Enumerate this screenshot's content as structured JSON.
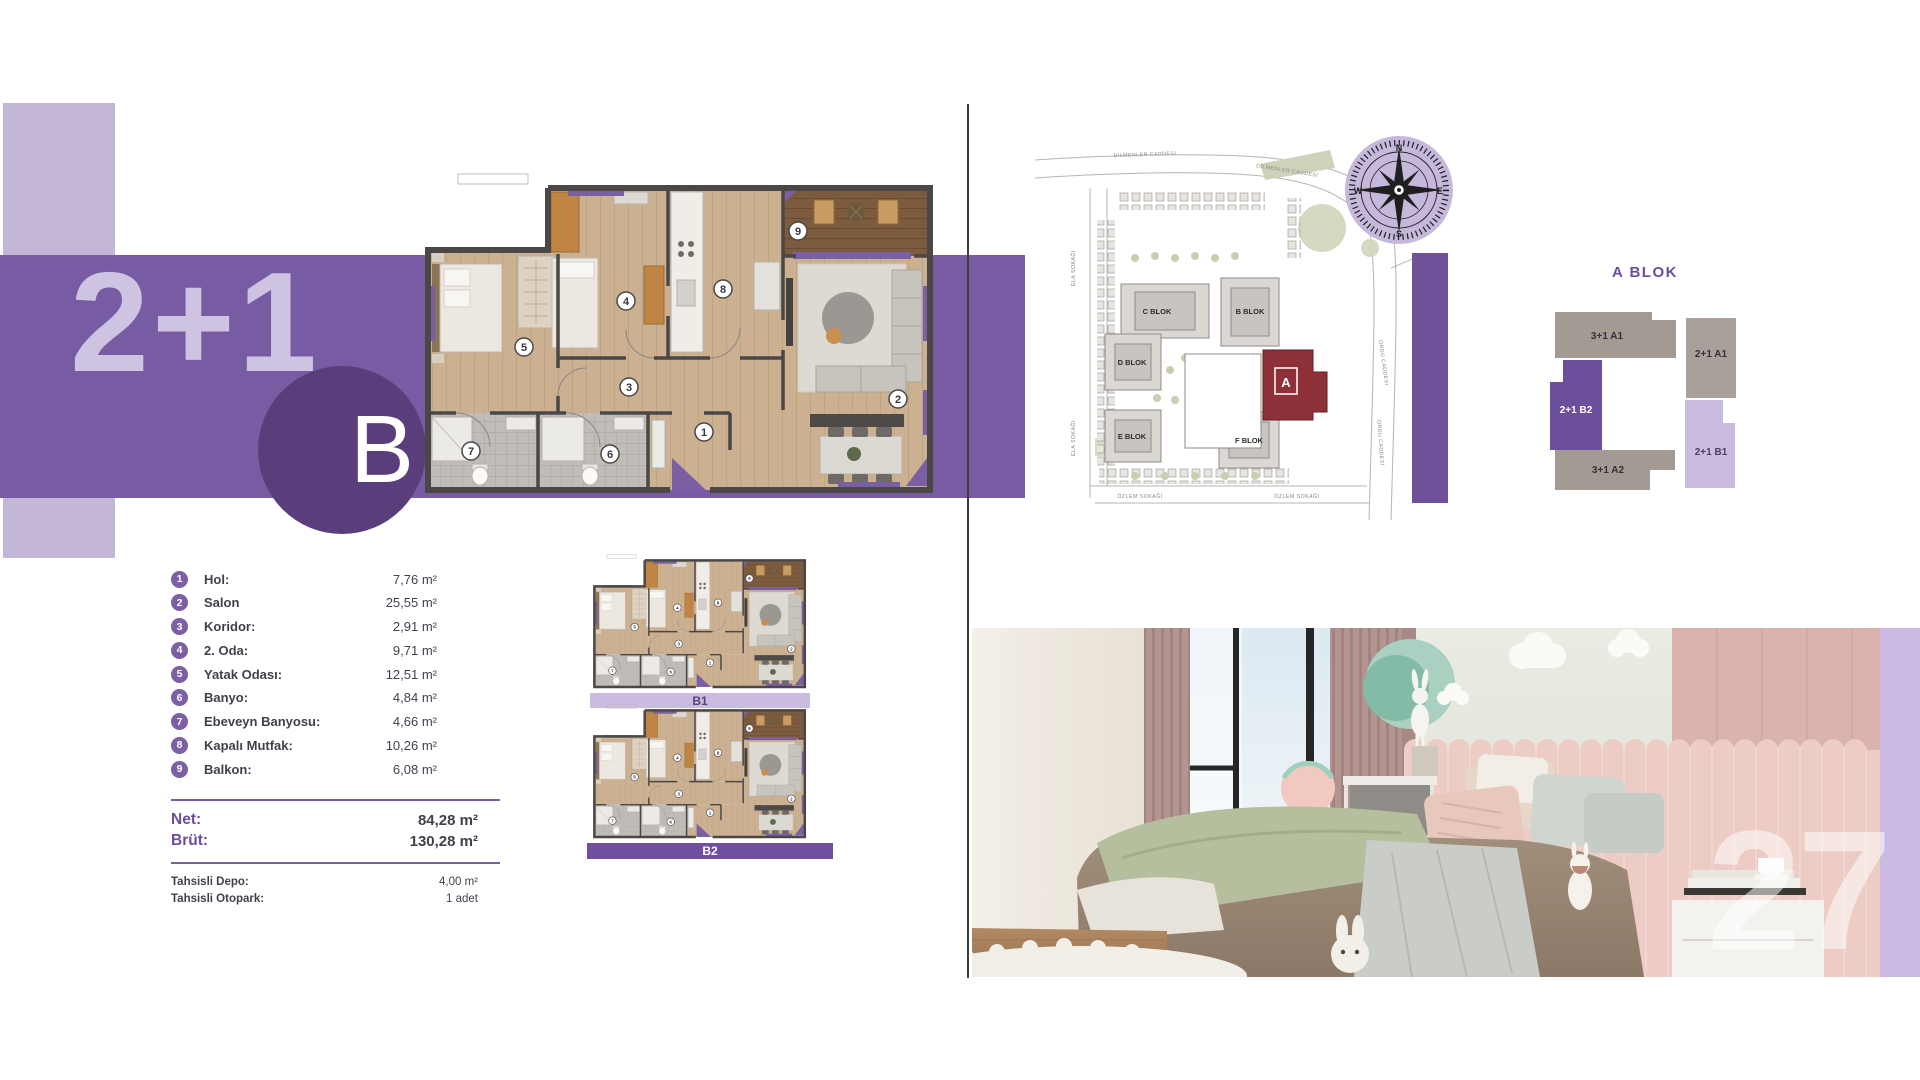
{
  "unit": {
    "type_label": "2+1",
    "variant_label": "B"
  },
  "room_list": [
    {
      "num": "1",
      "label": "Hol:",
      "area": "7,76 m²"
    },
    {
      "num": "2",
      "label": "Salon",
      "area": "25,55 m²"
    },
    {
      "num": "3",
      "label": "Koridor:",
      "area": "2,91 m²"
    },
    {
      "num": "4",
      "label": "2. Oda:",
      "area": "9,71 m²"
    },
    {
      "num": "5",
      "label": "Yatak Odası:",
      "area": "12,51 m²"
    },
    {
      "num": "6",
      "label": "Banyo:",
      "area": "4,84 m²"
    },
    {
      "num": "7",
      "label": "Ebeveyn Banyosu:",
      "area": "4,66 m²"
    },
    {
      "num": "8",
      "label": "Kapalı Mutfak:",
      "area": "10,26 m²"
    },
    {
      "num": "9",
      "label": "Balkon:",
      "area": "6,08 m²"
    }
  ],
  "totals": {
    "net_label": "Net:",
    "net_value": "84,28 m²",
    "brut_label": "Brüt:",
    "brut_value": "130,28 m²"
  },
  "allocations": [
    {
      "label": "Tahsisli Depo:",
      "value": "4,00 m²"
    },
    {
      "label": "Tahsisli Otopark:",
      "value": "1 adet"
    }
  ],
  "mini_plans": {
    "b1_label": "B1",
    "b2_label": "B2"
  },
  "site_map": {
    "streets": {
      "dilmenler": "DİLMENLER CADDESİ",
      "ela": "ELA SOKAĞI",
      "ozlem": "ÖZLEM SOKAĞI",
      "ordu": "ORDU CADDESİ"
    },
    "blocks": {
      "c": "C BLOK",
      "b": "B BLOK",
      "d": "D BLOK",
      "e": "E BLOK",
      "f": "F BLOK",
      "a": "A"
    }
  },
  "compass": {
    "n": "N",
    "e": "E",
    "s": "S",
    "w": "W"
  },
  "block_diagram": {
    "title": "A BLOK",
    "unit_3_1_a1": "3+1 A1",
    "unit_2_1_a1": "2+1 A1",
    "unit_2_1_b2": "2+1 B2",
    "unit_2_1_b1": "2+1 B1",
    "unit_3_1_a2": "3+1 A2"
  },
  "page_number": "27",
  "colors": {
    "band_purple": "#775CA3",
    "light_lavender": "#C3B6D7",
    "deep_purple": "#5A3E7C",
    "accent_purple": "#6E5199",
    "plan_accent": "#7B5FA5",
    "b1_bar": "#C9BCE0",
    "b2_bar": "#6F4F9E",
    "site_highlight_red": "#8E3038"
  }
}
